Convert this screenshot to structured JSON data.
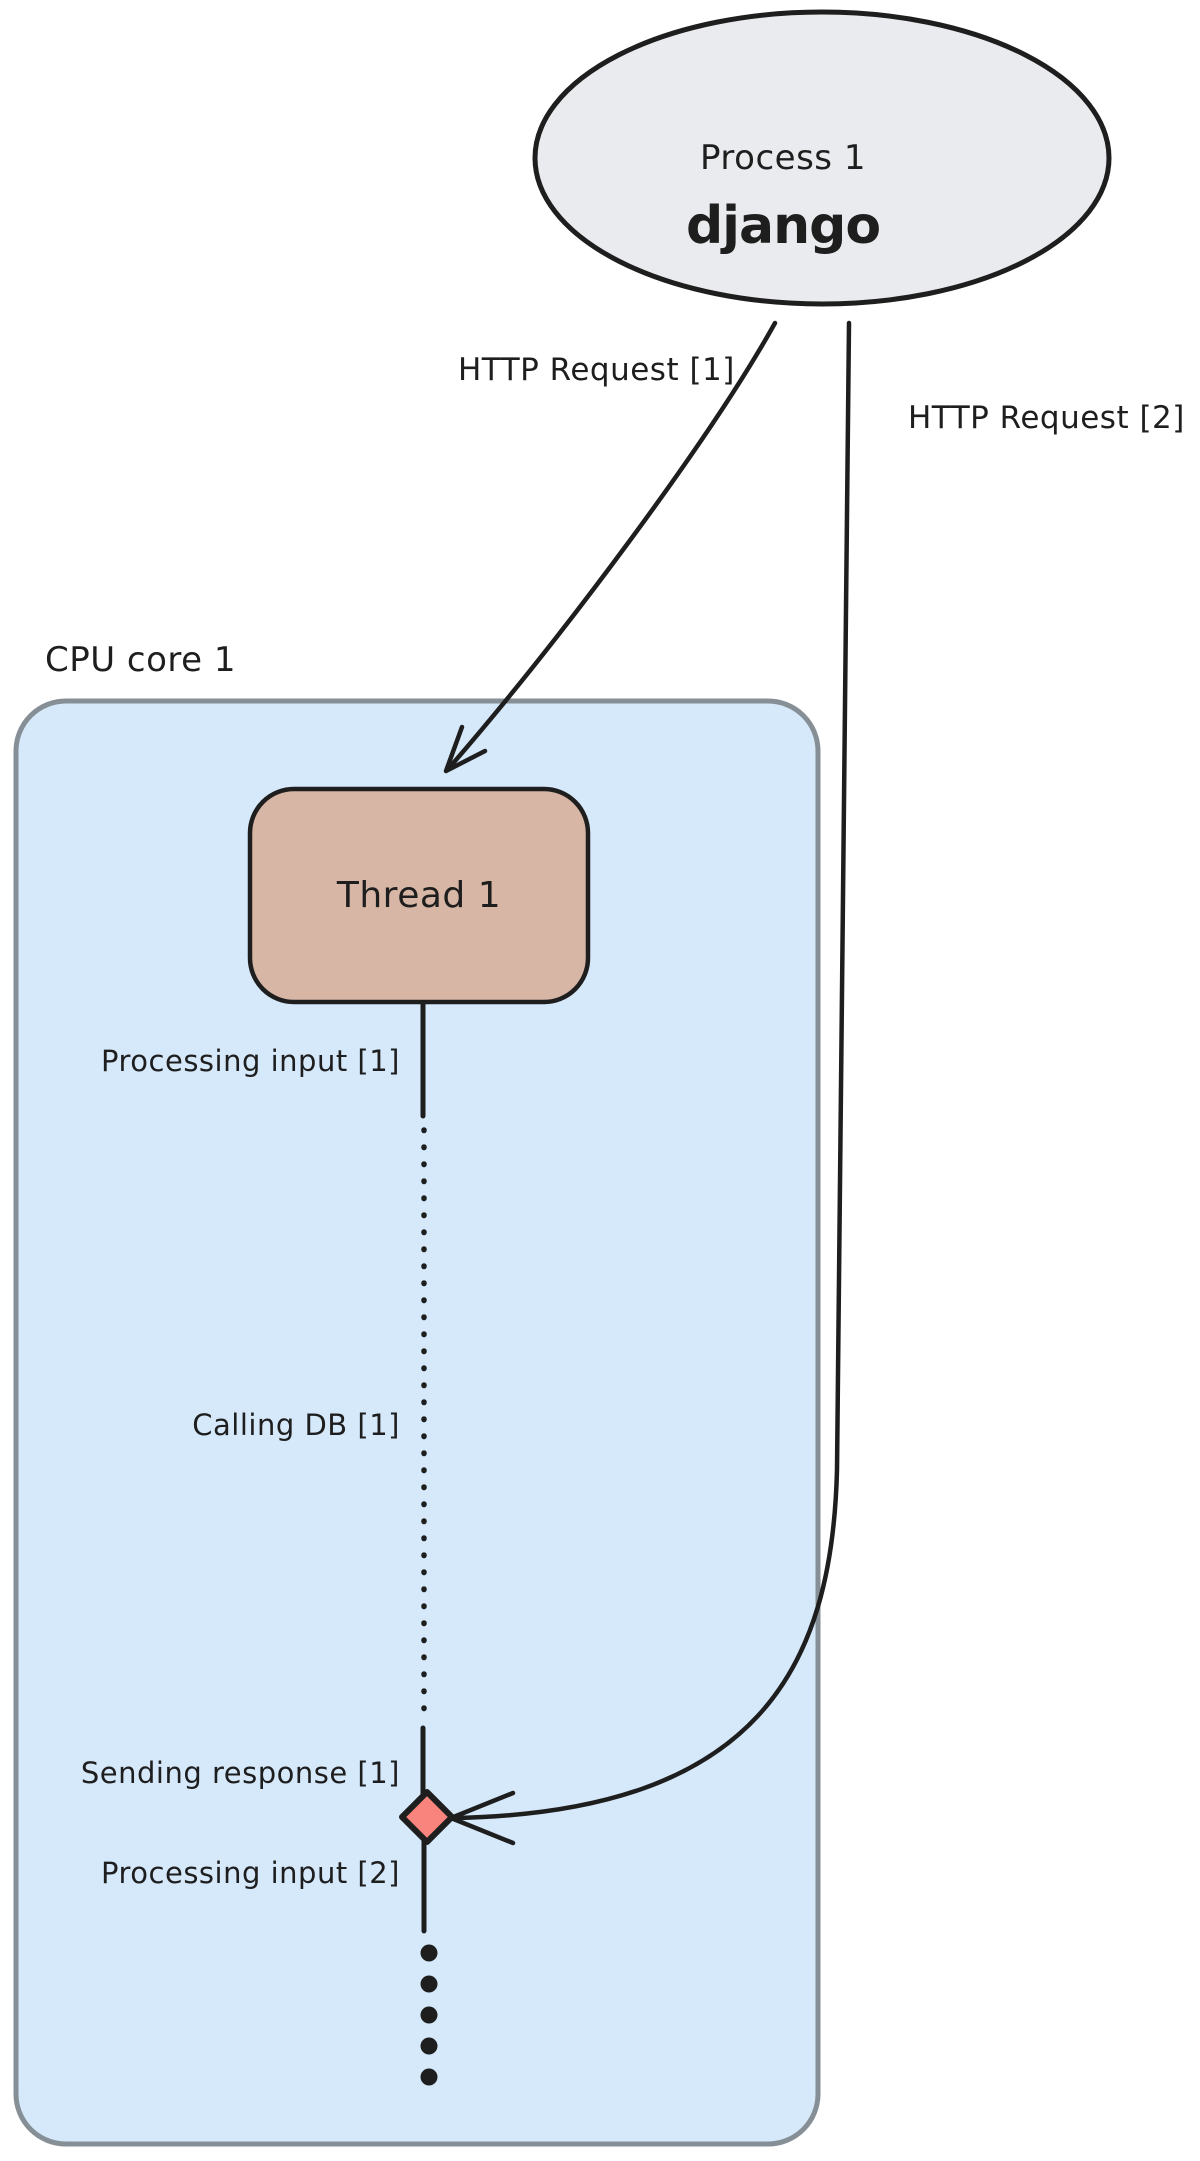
{
  "process_node": {
    "title": "Process 1",
    "logo": "django"
  },
  "requests": {
    "request1_label": "HTTP Request [1]",
    "request2_label": "HTTP Request [2]"
  },
  "cpu_core": {
    "label": "CPU core 1"
  },
  "thread": {
    "label": "Thread 1"
  },
  "timeline": {
    "processing_input_1": "Processing input [1]",
    "calling_db_1": "Calling DB [1]",
    "sending_response_1": "Sending response [1]",
    "processing_input_2": "Processing input [2]"
  },
  "colors": {
    "ink": "#1e1e1e",
    "process_fill": "#e9ebee",
    "cpu_fill": "#d6e9fb",
    "cpu_stroke": "#878f96",
    "thread_fill": "#d8b6a6",
    "event_marker_fill": "#f9837d"
  }
}
